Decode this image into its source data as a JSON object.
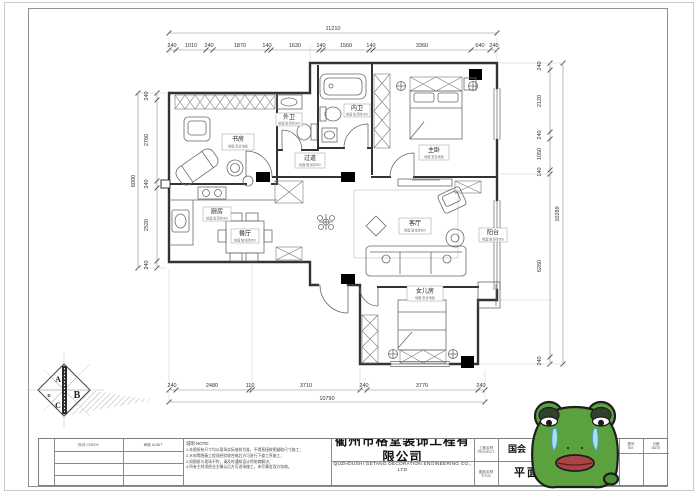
{
  "dims": {
    "top": {
      "total": "11210",
      "segments": [
        "240",
        "1010",
        "240",
        "1870",
        "140",
        "1630",
        "140",
        "1560",
        "140",
        "3360",
        "640",
        "240"
      ]
    },
    "left": {
      "total": "6000",
      "segments": [
        "240",
        "2760",
        "240",
        "2520",
        "240"
      ]
    },
    "right": {
      "total": "10289",
      "segments": [
        "240",
        "2120",
        "240",
        "1050",
        "140",
        "6260",
        "240"
      ]
    },
    "bottom": {
      "total": "10790",
      "segments": [
        "240",
        "2480",
        "110",
        "3710",
        "240",
        "3770",
        "240"
      ]
    }
  },
  "rooms": [
    {
      "name": "书房",
      "sub": "地面:复合地板"
    },
    {
      "name": "外卫",
      "sub": "地面:防滑砖300"
    },
    {
      "name": "内卫",
      "sub": "地面:防滑砖300"
    },
    {
      "name": "过道",
      "sub": "地面:玻化砖800"
    },
    {
      "name": "厨房",
      "sub": "地面:防滑砖300"
    },
    {
      "name": "餐厅",
      "sub": "地面:玻化砖800"
    },
    {
      "name": "主卧",
      "sub": "地面:复合地板"
    },
    {
      "name": "客厅",
      "sub": "地面:玻化砖800"
    },
    {
      "name": "阳台",
      "sub": "地面:防滑砖300"
    },
    {
      "name": "女儿房",
      "sub": "地面:复合地板"
    }
  ],
  "axis_badge": {
    "a": "A",
    "b": "B",
    "c": "C",
    "d": "D"
  },
  "title_block": {
    "col1_label": "校对 CHECK",
    "col2_label": "审核 AUDIT",
    "note_header": "说明  NOTE:",
    "note_lines": [
      "1.本图所有尺寸均以现场实际放样为准，不得直接按图量取尺寸施工；",
      "2.水电等隐蔽工程须经验收合格后方可进行下道工序施工；",
      "3.如图纸与现场不符，请及时通知设计师协商解决；",
      "4.所有主材须经业主确认后方可进场施工，未尽事宜双方协商。"
    ],
    "company_cn": "衢州市格堂装饰工程有限公司",
    "company_en": "QUZHOUSHI  GETANG  DECORATION  ENGINEERING  CO., LTD",
    "proj_label": "工程名称",
    "proj_label_sub": "PROJECT",
    "proj_value": "国会",
    "title_label": "图纸名称",
    "title_label_sub": "TITLE",
    "title_value": "平面布置图",
    "meta": [
      {
        "label": "图别",
        "sub": "DWG"
      },
      {
        "label": "图号",
        "sub": "NO."
      },
      {
        "label": "日期",
        "sub": "DATE"
      }
    ]
  },
  "colors": {
    "wall": "#333333",
    "frog_green": "#5ba23f",
    "tear_blue": "#a8ddf2",
    "lip_red": "#a94442"
  }
}
